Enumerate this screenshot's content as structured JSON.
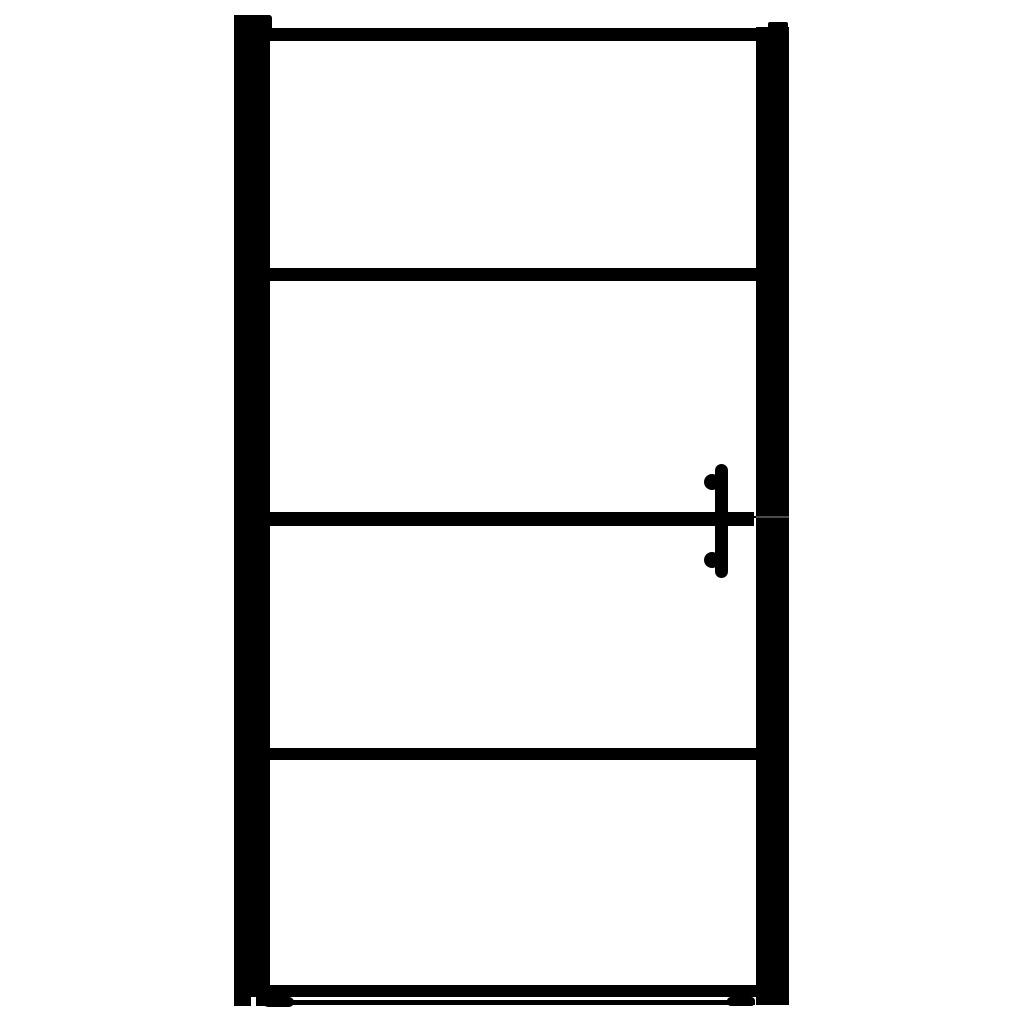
{
  "scene": {
    "type": "product-photo",
    "subject": "black framed glass door with four glass sections",
    "background": "plain white, no text, no watermark",
    "text_content": "none"
  },
  "colors": {
    "frame": "#000000",
    "background": "#ffffff",
    "seam": "#4a4a4a"
  },
  "door": {
    "glass_panel_count": 4,
    "crossbar_count": 5,
    "wall_profiles": [
      "left",
      "right"
    ],
    "handle": {
      "side": "right",
      "style": "vertical bar",
      "standoff_count": 2
    },
    "bottom_seal": "thin strip with rounded end caps below bottom rail",
    "parts": [
      {
        "name": "left-wall-profile"
      },
      {
        "name": "left-profile-bracket"
      },
      {
        "name": "right-wall-profile"
      },
      {
        "name": "right-profile-bracket"
      },
      {
        "name": "top-rail"
      },
      {
        "name": "crossbar-2"
      },
      {
        "name": "crossbar-3-handle-level"
      },
      {
        "name": "crossbar-4"
      },
      {
        "name": "bottom-rail"
      },
      {
        "name": "bottom-seal-strip"
      },
      {
        "name": "glass-panel-1"
      },
      {
        "name": "glass-panel-2"
      },
      {
        "name": "glass-panel-3"
      },
      {
        "name": "glass-panel-4"
      },
      {
        "name": "handle-bar"
      },
      {
        "name": "handle-standoff-top"
      },
      {
        "name": "handle-standoff-bottom"
      }
    ]
  }
}
